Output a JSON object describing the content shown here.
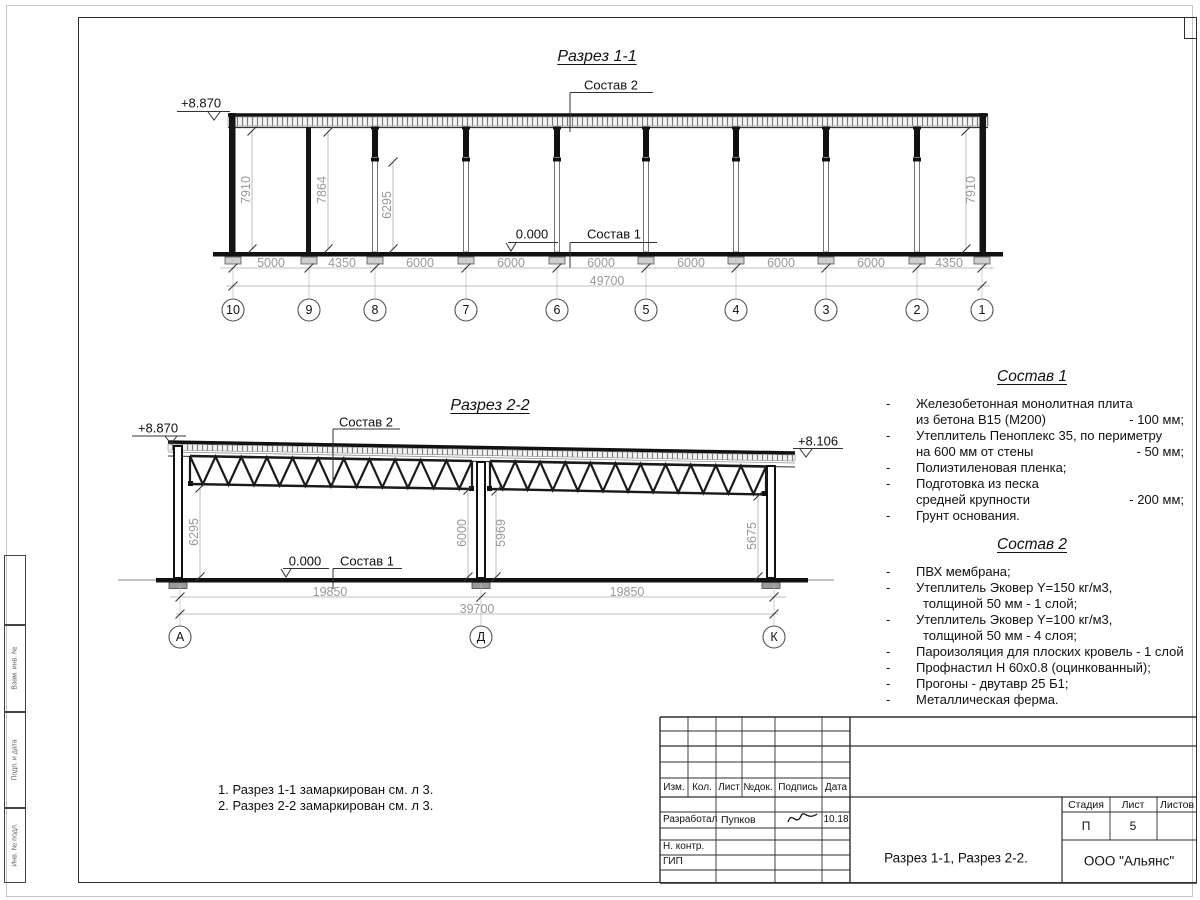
{
  "colors": {
    "line": "#1c1c1c",
    "dim_text": "#9a9a9a",
    "frame": "#2e2e2e"
  },
  "section1": {
    "title": "Разрез 1-1",
    "elev_left": "+8.870",
    "label_sostav2": "Состав 2",
    "label_sostav1": "Состав 1",
    "label_zero": "0.000",
    "height_dims": [
      "7910",
      "7864",
      "6295",
      "7910"
    ],
    "bay_dims": [
      "5000",
      "4350",
      "6000",
      "6000",
      "6000",
      "6000",
      "6000",
      "6000",
      "4350"
    ],
    "total": "49700",
    "axes": [
      "10",
      "9",
      "8",
      "7",
      "6",
      "5",
      "4",
      "3",
      "2",
      "1"
    ]
  },
  "section2": {
    "title": "Разрез 2-2",
    "elev_left": "+8.870",
    "elev_right": "+8.106",
    "label_sostav2": "Состав 2",
    "label_sostav1": "Состав 1",
    "label_zero": "0.000",
    "height_dims": [
      "6295",
      "6000",
      "5969",
      "5675"
    ],
    "span_dims": [
      "19850",
      "19850"
    ],
    "total": "39700",
    "axes": [
      "А",
      "Д",
      "К"
    ]
  },
  "comp1": {
    "title": "Состав 1",
    "rows": [
      {
        "dash": "-",
        "text": "Железобетонная  монолитная плита",
        "value": ""
      },
      {
        "dash": "",
        "text": "из бетона В15 (М200)",
        "value": "- 100 мм;"
      },
      {
        "dash": "-",
        "text": "Утеплитель Пеноплекс 35, по периметру",
        "value": ""
      },
      {
        "dash": "",
        "text": "на 600 мм от стены",
        "value": "- 50 мм;"
      },
      {
        "dash": "-",
        "text": "Полиэтиленовая пленка;",
        "value": ""
      },
      {
        "dash": "-",
        "text": "Подготовка из песка",
        "value": ""
      },
      {
        "dash": "",
        "text": "средней крупности",
        "value": "- 200 мм;"
      },
      {
        "dash": "-",
        "text": "Грунт основания.",
        "value": ""
      }
    ]
  },
  "comp2": {
    "title": "Состав 2",
    "rows": [
      {
        "dash": "-",
        "text": "ПВХ мембрана;",
        "value": ""
      },
      {
        "dash": "-",
        "text": "Утеплитель Эковер Y=150 кг/м3,",
        "value": ""
      },
      {
        "dash": "",
        "text": "толщиной 50 мм - 1 слой;",
        "value": ""
      },
      {
        "dash": "-",
        "text": "Утеплитель Эковер Y=100 кг/м3,",
        "value": ""
      },
      {
        "dash": "",
        "text": "толщиной 50 мм - 4 слоя;",
        "value": ""
      },
      {
        "dash": "-",
        "text": "Пароизоляция для плоских кровель - 1 слой;",
        "value": ""
      },
      {
        "dash": "-",
        "text": "Профнастил Н 60х0.8 (оцинкованный);",
        "value": ""
      },
      {
        "dash": "-",
        "text": "Прогоны - двутавр 25 Б1;",
        "value": ""
      },
      {
        "dash": "-",
        "text": "Металлическая ферма.",
        "value": ""
      }
    ]
  },
  "notes": [
    "1. Разрез 1-1 замаркирован см. л 3.",
    "2. Разрез 2-2 замаркирован см. л 3."
  ],
  "titleblock": {
    "cols": [
      "Изм.",
      "Кол.",
      "Лист",
      "№док.",
      "Подпись",
      "Дата"
    ],
    "developer_label": "Разработал",
    "developer_name": "Пупков",
    "date": "10.18",
    "ncontr": "Н. контр.",
    "gip": "ГИП",
    "stage_label": "Стадия",
    "sheet_label": "Лист",
    "sheets_label": "Листов",
    "stage": "П",
    "sheet": "5",
    "sheets": "",
    "doc_title": "Разрез 1-1, Разрез 2-2.",
    "company": "ООО \"Альянс\""
  },
  "side_stamp": [
    "Взам. инв. №",
    "Подп. и дата",
    "Инв. № подл."
  ]
}
